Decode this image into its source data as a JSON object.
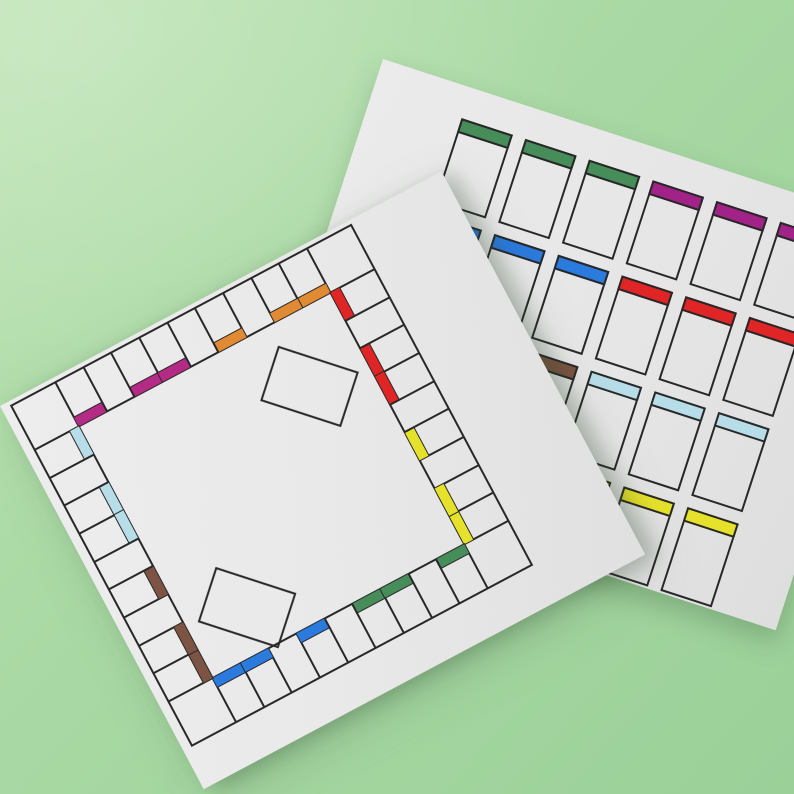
{
  "scene": {
    "description": "Blank printable board game template: game board sheet laid over a sheet of blank property cards on a green surface",
    "background_green_light": "#bce3b2",
    "background_green_dark": "#9bd099",
    "paper_color": "#e9e9e9",
    "line_color": "#282828"
  },
  "palette": {
    "pink": "#b32b84",
    "magenta": "#a12387",
    "orange": "#e08a33",
    "red": "#df2525",
    "yellow": "#e6e22b",
    "green": "#468d59",
    "blue": "#2b7ade",
    "light_blue": "#b6dde8",
    "brown": "#7d5443"
  },
  "board": {
    "spaces_per_side": 9,
    "corner_count": 4,
    "corners": [
      "top-left",
      "top-right",
      "bottom-left",
      "bottom-right"
    ],
    "sides": {
      "top": [
        "pink",
        null,
        "pink",
        "pink",
        null,
        "orange",
        null,
        "orange",
        "orange"
      ],
      "right": [
        "red",
        null,
        "red",
        "red",
        null,
        "yellow",
        null,
        "yellow",
        "yellow"
      ],
      "bottom": [
        "blue",
        "blue",
        null,
        "blue",
        null,
        "green",
        "green",
        null,
        "green"
      ],
      "left": [
        "light_blue",
        null,
        "light_blue",
        "light_blue",
        null,
        "brown",
        null,
        "brown",
        "brown"
      ]
    },
    "center_zones": [
      {
        "name": "card-zone-1",
        "position": "upper-right"
      },
      {
        "name": "card-zone-2",
        "position": "lower-left"
      }
    ]
  },
  "card_sheet": {
    "columns": 6,
    "row_count": 4,
    "rows": [
      [
        "green",
        "green",
        "green",
        "magenta",
        "magenta",
        "magenta"
      ],
      [
        "blue",
        "blue",
        "blue",
        "red",
        "red",
        "red"
      ],
      [
        "brown",
        "brown",
        "brown",
        "light_blue",
        "light_blue",
        "light_blue"
      ],
      [
        "orange",
        "orange",
        "orange",
        "yellow",
        "yellow",
        "yellow"
      ]
    ]
  }
}
